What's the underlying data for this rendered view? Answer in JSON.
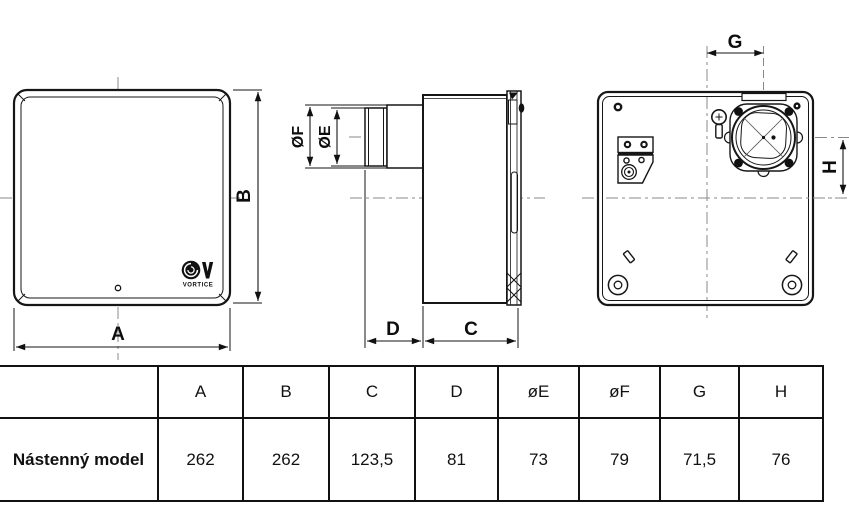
{
  "drawing": {
    "front_view": {
      "dim_width_label": "A",
      "dim_height_label": "B",
      "logo_text": "VORTICE"
    },
    "side_view": {
      "dim_outer_diameter_label": "ØF",
      "dim_inner_diameter_label": "ØE",
      "dim_spigot_depth_label": "D",
      "dim_body_depth_label": "C"
    },
    "rear_view": {
      "dim_horizontal_offset_label": "G",
      "dim_vertical_offset_label": "H"
    }
  },
  "table": {
    "row_label": "Nástenný model",
    "headers": [
      "A",
      "B",
      "C",
      "D",
      "øE",
      "øF",
      "G",
      "H"
    ],
    "values": [
      "262",
      "262",
      "123,5",
      "81",
      "73",
      "79",
      "71,5",
      "76"
    ]
  },
  "colors": {
    "line": "#161616",
    "centerline": "#8a8a8a",
    "background": "#ffffff"
  }
}
